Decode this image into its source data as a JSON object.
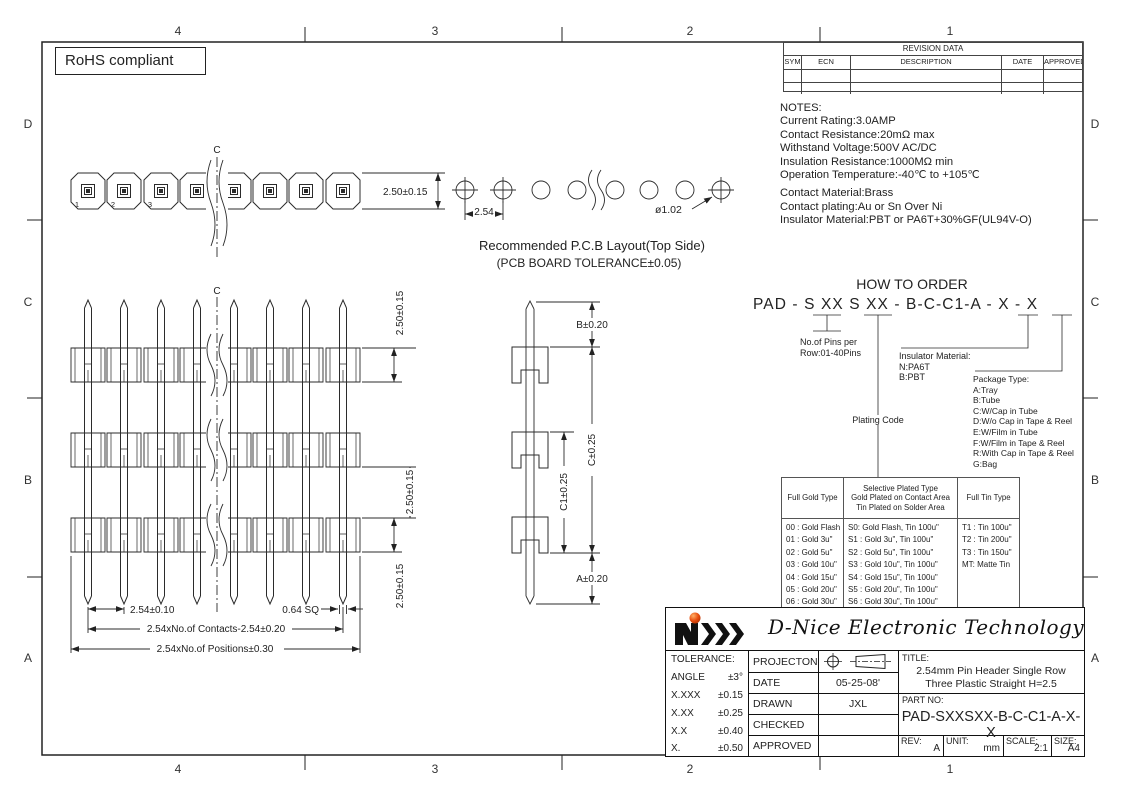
{
  "zones": {
    "cols": [
      "4",
      "3",
      "2",
      "1"
    ],
    "rows": [
      "D",
      "C",
      "B",
      "A"
    ]
  },
  "rohs": "RoHS compliant",
  "revision": {
    "title": "REVISION  DATA",
    "headers": [
      "SYM",
      "ECN",
      "DESCRIPTION",
      "DATE",
      "APPROVED"
    ]
  },
  "notes": {
    "heading": "NOTES:",
    "lines1": [
      "Current  Rating:3.0AMP",
      "Contact  Resistance:20mΩ max",
      "Withstand  Voltage:500V  AC/DC",
      "Insulation  Resistance:1000MΩ  min",
      "Operation  Temperature:-40℃  to  +105℃"
    ],
    "lines2": [
      "Contact  Material:Brass",
      "Contact  plating:Au  or  Sn  Over  Ni",
      "Insulator  Material:PBT or PA6T+30%GF(UL94V-O)"
    ]
  },
  "order": {
    "heading": "HOW TO ORDER",
    "part_string": "PAD - S XX S XX -  B-C-C1-A  - X - X",
    "pins_label": [
      "No.of Pins per",
      "Row:01-40Pins"
    ],
    "plating_label": "Plating Code",
    "insulator_label": [
      "Insulator Material:",
      "N:PA6T",
      "B:PBT"
    ],
    "package_label": [
      "Package Type:",
      "A:Tray",
      "B:Tube",
      "C:W/Cap in Tube",
      "D:W/o Cap in Tape & Reel",
      "E:W/Film in Tube",
      "F:W/Film in Tape & Reel",
      "R:With Cap in Tape & Reel",
      "G:Bag"
    ]
  },
  "plating_table": {
    "h1": "Full Gold Type",
    "h2a": "Selective Plated Type",
    "h2b": "Gold Plated on Contact Area",
    "h2c": "Tin Plated on Solder Area",
    "h3": "Full Tin Type",
    "gold": [
      "00 : Gold Flash",
      "01 : Gold 3u\"",
      "02 : Gold 5u\"",
      "03 : Gold 10u\"",
      "04 : Gold 15u\"",
      "05 : Gold 20u\"",
      "06 : Gold 30u\""
    ],
    "selective": [
      "S0: Gold Flash, Tin 100u\"",
      "S1 : Gold 3u\",  Tin 100u\"",
      "S2 : Gold 5u\",  Tin 100u\"",
      "S3 : Gold 10u\", Tin 100u\"",
      "S4 : Gold 15u\", Tin 100u\"",
      "S5 : Gold 20u\", Tin 100u\"",
      "S6 : Gold 30u\", Tin 100u\""
    ],
    "tin": [
      "T1 : Tin 100u\"",
      "T2 : Tin 200u\"",
      "T3 : Tin 150u\"",
      "MT: Matte Tin"
    ]
  },
  "pcb": {
    "caption1": "Recommended  P.C.B  Layout(Top  Side)",
    "caption2": "(PCB  BOARD  TOLERANCE±0.05)",
    "pitch": "2.54",
    "hole": "ø1.02"
  },
  "dims": {
    "tv_height": "2.50±0.15",
    "fv_h1": "2.50±0.15",
    "fv_h2": "2.50±0.15",
    "fv_h3": "2.50±0.15",
    "pitch": "2.54±0.10",
    "sq": "0.64  SQ",
    "contacts": "2.54xNo.of  Contacts-2.54±0.20",
    "positions": "2.54xNo.of  Positions±0.30",
    "b": "B±0.20",
    "c": "C±0.25",
    "c1": "C1±0.25",
    "a": "A±0.20",
    "centerline": "C",
    "pin1": "1",
    "pin2": "2",
    "pin3": "3"
  },
  "titleblock": {
    "company": "D-Nice Electronic Technology",
    "tolerance": {
      "heading": "TOLERANCE:",
      "rows": [
        [
          "ANGLE",
          "±3°"
        ],
        [
          "X.XXX",
          "±0.15"
        ],
        [
          "X.XX",
          "±0.25"
        ],
        [
          "X.X",
          "±0.40"
        ],
        [
          "X.",
          "±0.50"
        ]
      ]
    },
    "fields": [
      {
        "label": "PROJECTON",
        "value": ""
      },
      {
        "label": "DATE",
        "value": "05-25-08'"
      },
      {
        "label": "DRAWN",
        "value": "JXL"
      },
      {
        "label": "CHECKED",
        "value": ""
      },
      {
        "label": "APPROVED",
        "value": ""
      }
    ],
    "title_label": "TITLE:",
    "title_line1": "2.54mm  Pin Header Single Row",
    "title_line2": "Three Plastic Straight  H=2.5",
    "part_label": "PART  NO:",
    "part_no": "PAD-SXXSXX-B-C-C1-A-X-X",
    "rev_label": "REV:",
    "rev": "A",
    "unit_label": "UNIT:",
    "unit": "mm",
    "scale_label": "SCALE:",
    "scale": "2:1",
    "size_label": "SIZE:",
    "size": "A4"
  }
}
